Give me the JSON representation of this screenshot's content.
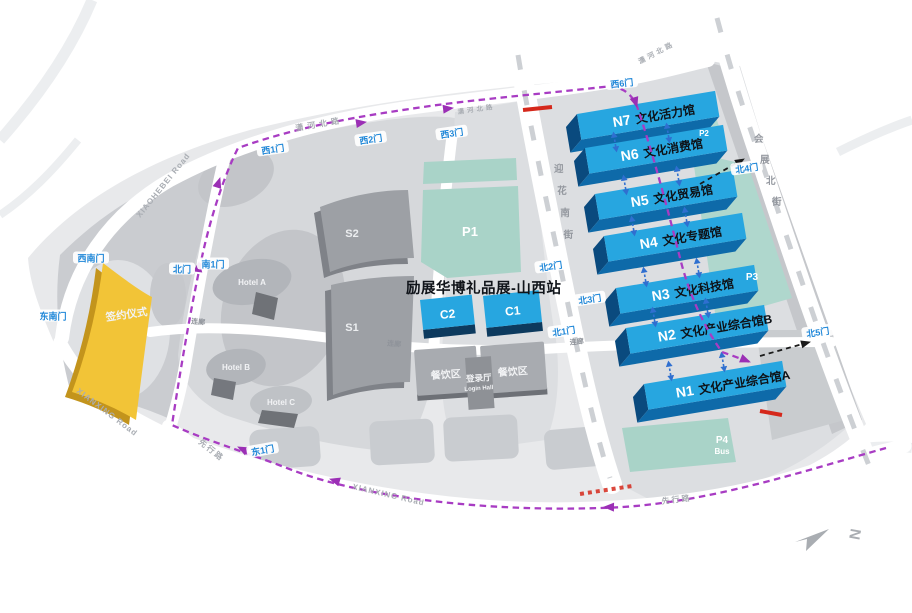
{
  "title": "励展华博礼品展-山西站",
  "halls": [
    {
      "id": "N7",
      "name": "文化活力馆"
    },
    {
      "id": "N6",
      "name": "文化消费馆"
    },
    {
      "id": "N5",
      "name": "文化贸易馆"
    },
    {
      "id": "N4",
      "name": "文化专题馆"
    },
    {
      "id": "N3",
      "name": "文化科技馆"
    },
    {
      "id": "N2",
      "name": "文化产业综合馆B"
    },
    {
      "id": "N1",
      "name": "文化产业综合馆A"
    }
  ],
  "buildings": {
    "c1": "C1",
    "c2": "C2",
    "s1": "S1",
    "s2": "S2",
    "hotel_a": "Hotel A",
    "hotel_b": "Hotel B",
    "hotel_c": "Hotel C",
    "dining_left": "餐饮区",
    "dining_right": "餐饮区",
    "login_hall": "登录厅",
    "login_hall_en": "Login Hall",
    "ceremony": "签约仪式"
  },
  "parking": {
    "p1": "P1",
    "p2": "P2",
    "p3": "P3",
    "p4": "P4",
    "p4_type": "Bus"
  },
  "gates": {
    "west1": "西1门",
    "west2": "西2门",
    "west3": "西3门",
    "west6": "西6门",
    "southwest": "西南门",
    "southeast": "东南门",
    "north": "北门",
    "south1": "南1门",
    "east1": "东1门",
    "north1": "北1门",
    "north2": "北2门",
    "north3": "北3门",
    "north4": "北4门",
    "north5": "北5门"
  },
  "roads": {
    "xiaohebei_en": "XIAOHEBEI Road",
    "xiaohebei_cn": "潇河北路",
    "xianxing_en": "XIANXING Road",
    "xianxing_cn": "先行路",
    "yinghua_south": "迎花南街",
    "huizhan_north": "会展北街"
  },
  "labels": {
    "corridor": "连廊"
  },
  "compass": {
    "north": "N"
  },
  "colors": {
    "hall_blue": "#27a6e0",
    "hall_blue_front": "#0e6aa9",
    "hall_blue_end": "#0a4a7e",
    "parking_teal": "#a9d3c8",
    "route_purple": "#a83cc3",
    "ceremony_yellow": "#f2c437",
    "gate_blue": "#1f87d8",
    "marker_red": "#d5281b",
    "building_gray": "#9da0a5"
  }
}
